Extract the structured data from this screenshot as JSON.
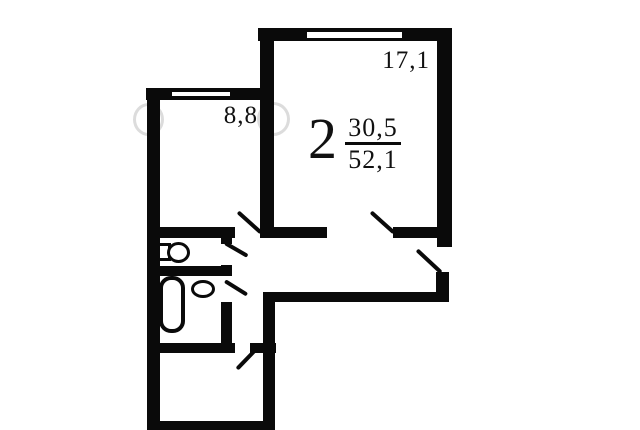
{
  "plan": {
    "type": "apartment-floor-plan",
    "apartment_label": {
      "rooms_count": "2",
      "living_area": "30,5",
      "total_area": "52,1"
    },
    "room_labels": {
      "living_room_area": "17,1",
      "small_room_area": "8,8"
    },
    "fixtures": [
      {
        "name": "toilet-icon"
      },
      {
        "name": "bathtub-icon"
      },
      {
        "name": "sink-icon"
      }
    ],
    "features": {
      "windows": 2,
      "door_swings": 6
    },
    "colors": {
      "wall": "#0a0a0a",
      "background": "#ffffff",
      "watermark": "#9a9a9a"
    }
  }
}
